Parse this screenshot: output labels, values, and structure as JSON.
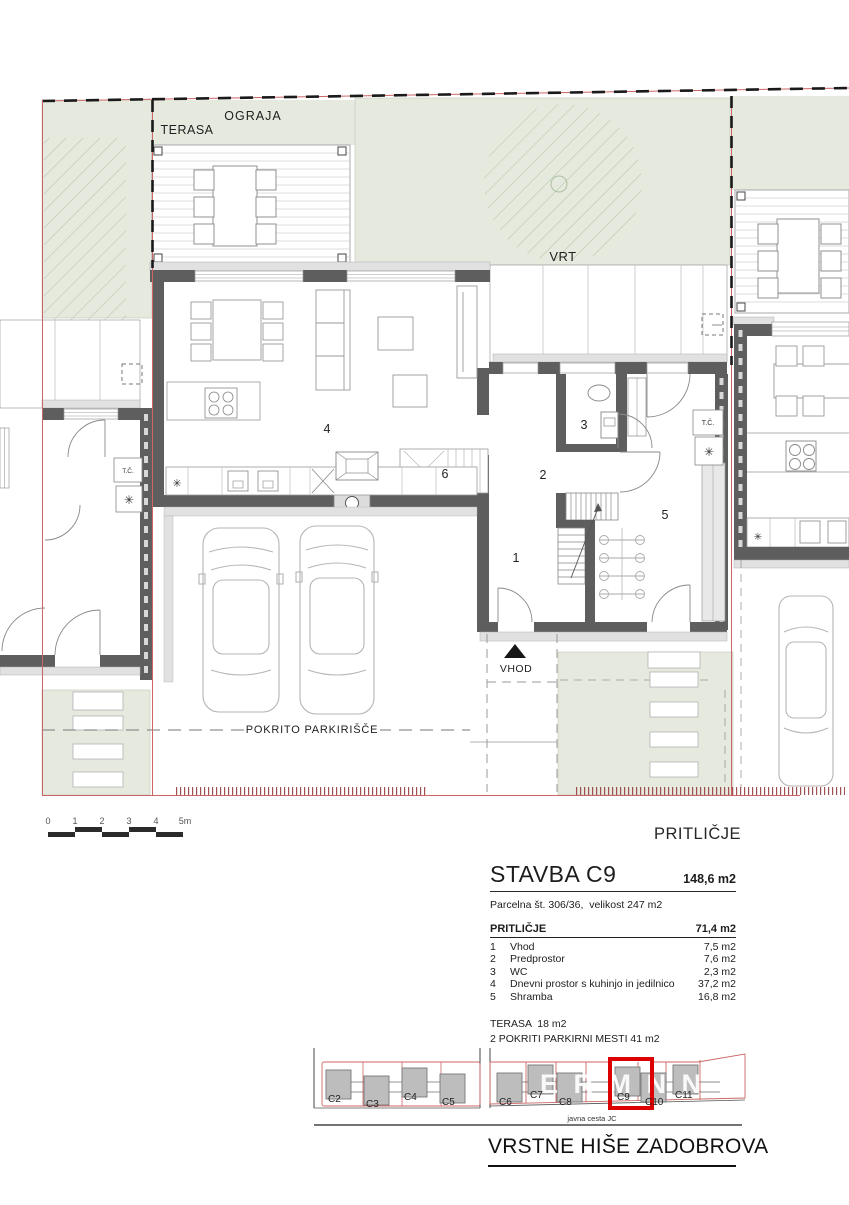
{
  "plan": {
    "labels": {
      "ograja": "OGRAJA",
      "terasa": "TERASA",
      "vrt": "VRT",
      "vhod": "VHOD",
      "covered_parking": "POKRITO PARKIRIŠČE",
      "heat_pump": "T.Č.",
      "floor_label": "PRITLIČJE"
    },
    "star": "✳",
    "room_numbers": {
      "r1": "1",
      "r2": "2",
      "r3": "3",
      "r4": "4",
      "r5": "5",
      "r6": "6"
    }
  },
  "scale_bar": {
    "ticks": [
      "0",
      "1",
      "2",
      "3",
      "4",
      "5m"
    ]
  },
  "info_panel": {
    "building_title": "STAVBA C9",
    "building_area": "148,6 m2",
    "parcel_line": "Parcelna št. 306/36,  velikost 247 m2",
    "floor_name": "PRITLIČJE",
    "floor_area": "71,4 m2",
    "rooms": [
      {
        "num": "1",
        "name": "Vhod",
        "area": "7,5 m2"
      },
      {
        "num": "2",
        "name": "Predprostor",
        "area": "7,6 m2"
      },
      {
        "num": "3",
        "name": "WC",
        "area": "2,3 m2"
      },
      {
        "num": "4",
        "name": "Dnevni prostor s kuhinjo in jedilnico",
        "area": "37,2 m2"
      },
      {
        "num": "5",
        "name": "Shramba",
        "area": "16,8 m2"
      }
    ],
    "terrace_line": "TERASA  18 m2",
    "parking_line": "2 POKRITI PARKIRNI MESTI 41 m2"
  },
  "site_plan": {
    "houses": [
      "C2",
      "C3",
      "C4",
      "C5",
      "C6",
      "C7",
      "C8",
      "C9",
      "C10",
      "C11"
    ],
    "highlighted_house": "C9",
    "road_label": "javna cesta JC",
    "watermark": "E R M N N"
  },
  "footer": {
    "project_title": "VRSTNE HIŠE ZADOBROVA"
  },
  "colors": {
    "garden_green": "#e5e9de",
    "wall_gray": "#5e5e5e",
    "highlight_red": "#dd0000",
    "boundary_red": "#cc6666",
    "box_gray": "#bdbdbd"
  }
}
